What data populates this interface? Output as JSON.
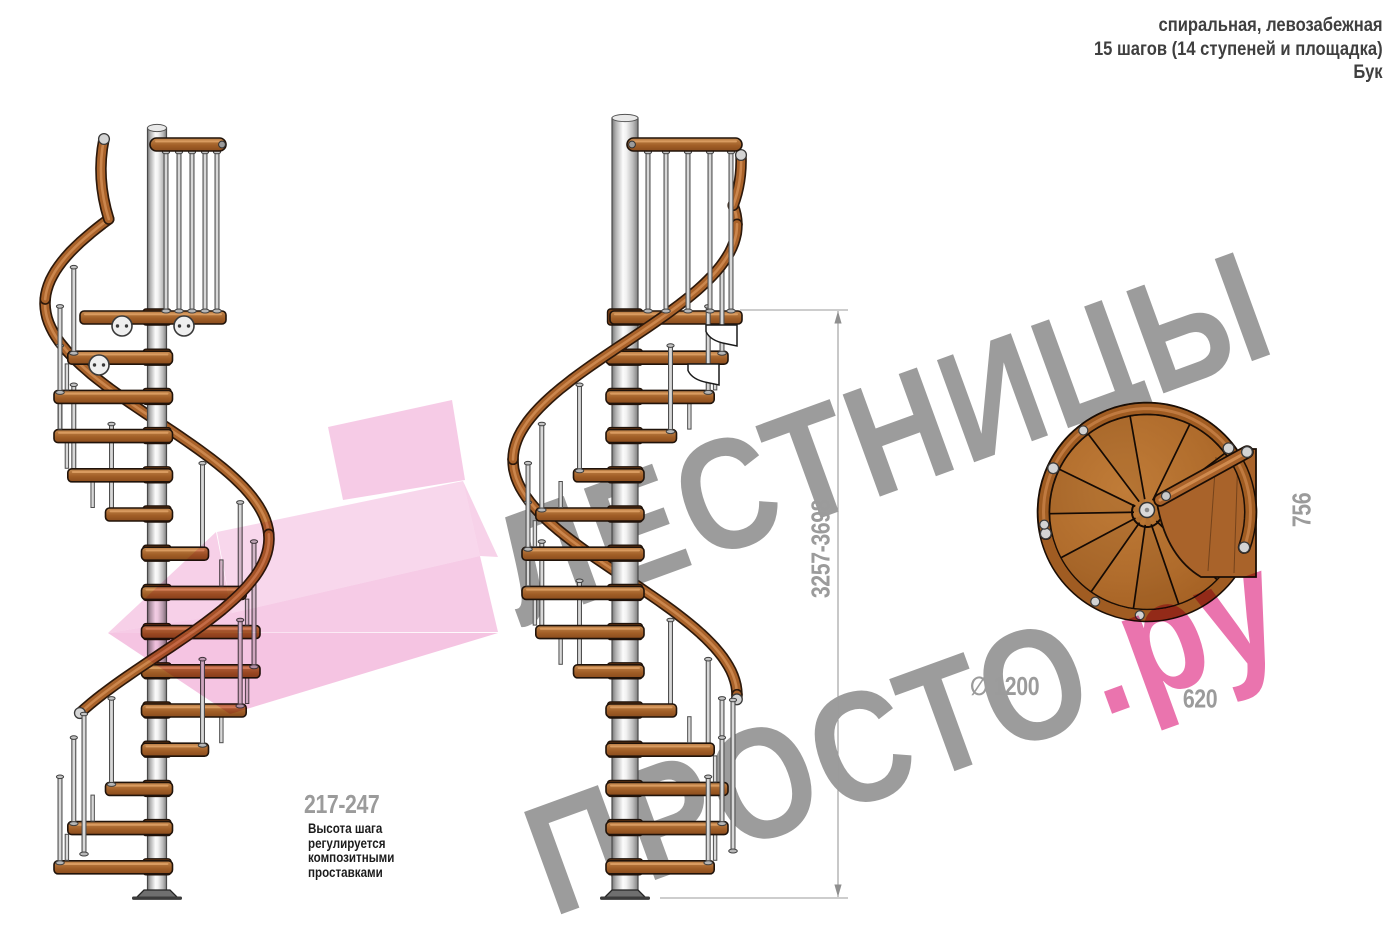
{
  "header": {
    "line1": "спиральная, левозабежная",
    "line2": "15 шагов (14 ступеней и площадка)",
    "line3": "Бук"
  },
  "dimensions": {
    "total_height": "3257-3698",
    "step_height": "217-247",
    "landing_depth": "756",
    "landing_width": "620",
    "diameter": "∅ 1200"
  },
  "note": {
    "text": "Высота шага\nрегулируется\nкомпозитными\nпроставками"
  },
  "watermark": {
    "line1": "ЛЕСТНИЦЫ",
    "line2_gray": "ПРОСТО",
    "line2_pink": ".ру"
  },
  "colors": {
    "watermark_gray": "#9c9c9c",
    "accent_pink": "#ee9ccf",
    "pink_text": "#ea74ae",
    "dimension_gray": "#9b9b9b",
    "wood": "#a9622a",
    "wood_light": "#c5854d",
    "handrail_dark": "#7c3b1c",
    "pole_silver": "#d9d9d9",
    "note_text": "#1c1c1c",
    "header_text": "#3f3f3f"
  }
}
